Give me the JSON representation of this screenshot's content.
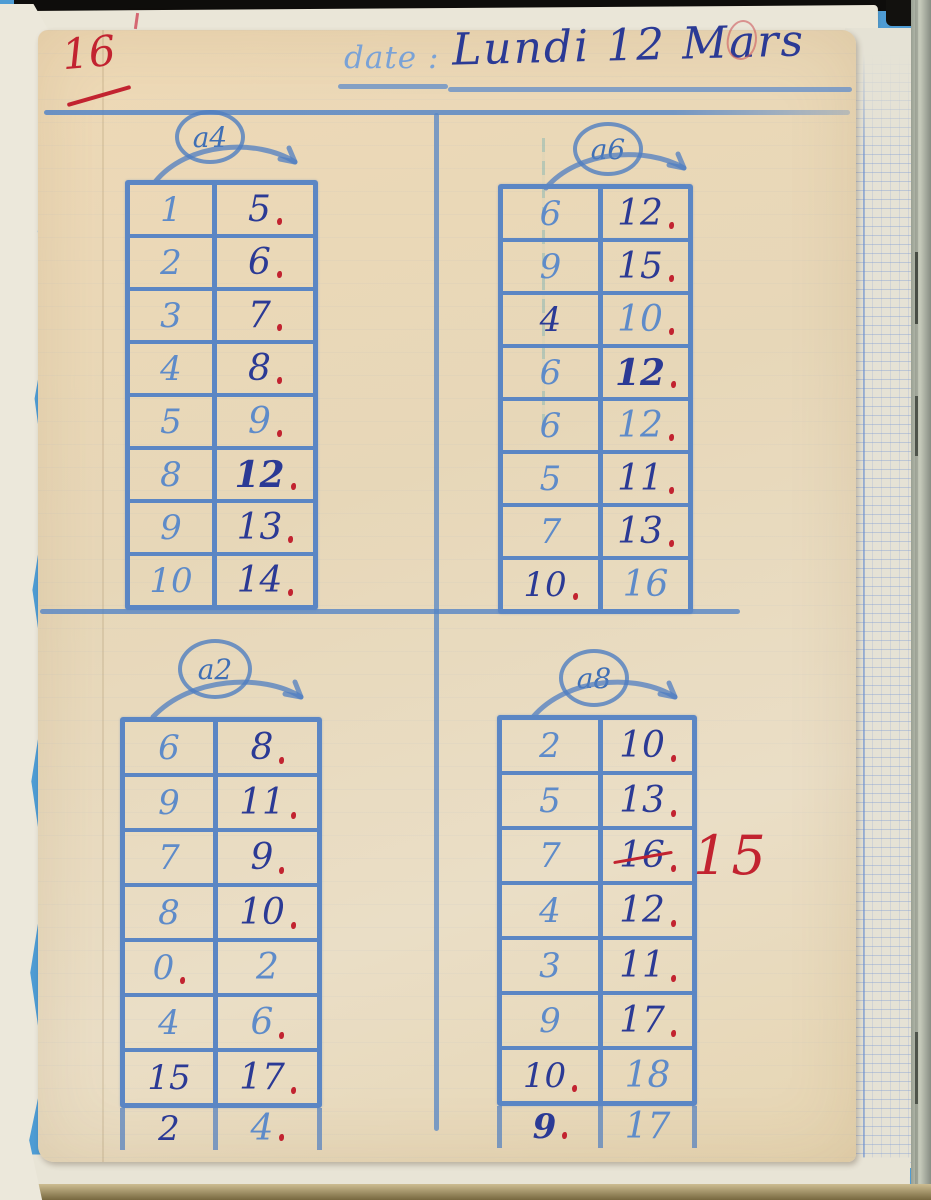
{
  "page": {
    "number": "16",
    "header": {
      "date_label": "date :",
      "date_value": "Lundi 12 Mars"
    }
  },
  "tables": [
    {
      "operation": "a4",
      "rows": [
        {
          "a": "1",
          "b": "5",
          "dot": true
        },
        {
          "a": "2",
          "b": "6",
          "dot": true
        },
        {
          "a": "3",
          "b": "7",
          "dot": true
        },
        {
          "a": "4",
          "b": "8",
          "dot": true
        },
        {
          "a": "5",
          "b": "9",
          "b_ink": "light",
          "dot": true
        },
        {
          "a": "8",
          "b": "12",
          "b_bold": true,
          "dot": true
        },
        {
          "a": "9",
          "b": "13",
          "dot": true
        },
        {
          "a": "10",
          "b": "14",
          "dot": true
        }
      ]
    },
    {
      "operation": "a6",
      "rows": [
        {
          "a": "6",
          "b": "12",
          "dot": true
        },
        {
          "a": "9",
          "b": "15",
          "dot": true
        },
        {
          "a": "4",
          "a_ink": "dark",
          "b": "10",
          "b_ink": "light",
          "dot": true
        },
        {
          "a": "6",
          "b": "12",
          "b_bold": true,
          "dot": true
        },
        {
          "a": "6",
          "b": "12",
          "b_ink": "light",
          "dot": true
        },
        {
          "a": "5",
          "b": "11",
          "dot": true
        },
        {
          "a": "7",
          "b": "13",
          "dot": true
        },
        {
          "a": "10",
          "a_ink": "dark",
          "dot_a": true,
          "b": "16",
          "b_ink": "light"
        }
      ]
    },
    {
      "operation": "a2",
      "rows": [
        {
          "a": "6",
          "b": "8",
          "dot": true
        },
        {
          "a": "9",
          "b": "11",
          "dot": true
        },
        {
          "a": "7",
          "b": "9",
          "dot": true
        },
        {
          "a": "8",
          "b": "10",
          "dot": true
        },
        {
          "a": "0",
          "dot_a": true,
          "b": "2",
          "b_ink": "light"
        },
        {
          "a": "4",
          "b": "6",
          "b_ink": "light",
          "dot": true
        },
        {
          "a": "15",
          "a_ink": "dark",
          "b": "17",
          "dot": true
        },
        {
          "a": "2",
          "a_ink": "dark",
          "b": "4",
          "b_ink": "light",
          "dot": true,
          "overflow": true
        }
      ]
    },
    {
      "operation": "a8",
      "rows": [
        {
          "a": "2",
          "b": "10",
          "dot": true
        },
        {
          "a": "5",
          "b": "13",
          "dot": true
        },
        {
          "a": "7",
          "b": "16",
          "strike": true,
          "dot": true
        },
        {
          "a": "4",
          "b": "12",
          "dot": true
        },
        {
          "a": "3",
          "b": "11",
          "dot": true
        },
        {
          "a": "9",
          "b": "17",
          "dot": true
        },
        {
          "a": "10",
          "a_ink": "dark",
          "dot_a": true,
          "b": "18",
          "b_ink": "light"
        },
        {
          "a": "9",
          "a_ink": "dark",
          "a_bold": true,
          "dot_a": true,
          "b": "17",
          "b_ink": "light",
          "overflow": true
        }
      ]
    }
  ],
  "correction": {
    "text": "15"
  },
  "colors": {
    "crayon_blue": "#5b86c4",
    "ink_dark": "#2b3a95",
    "ink_light": "#5e8bc9",
    "red": "#c22330",
    "paper": "#e9d8b7"
  }
}
